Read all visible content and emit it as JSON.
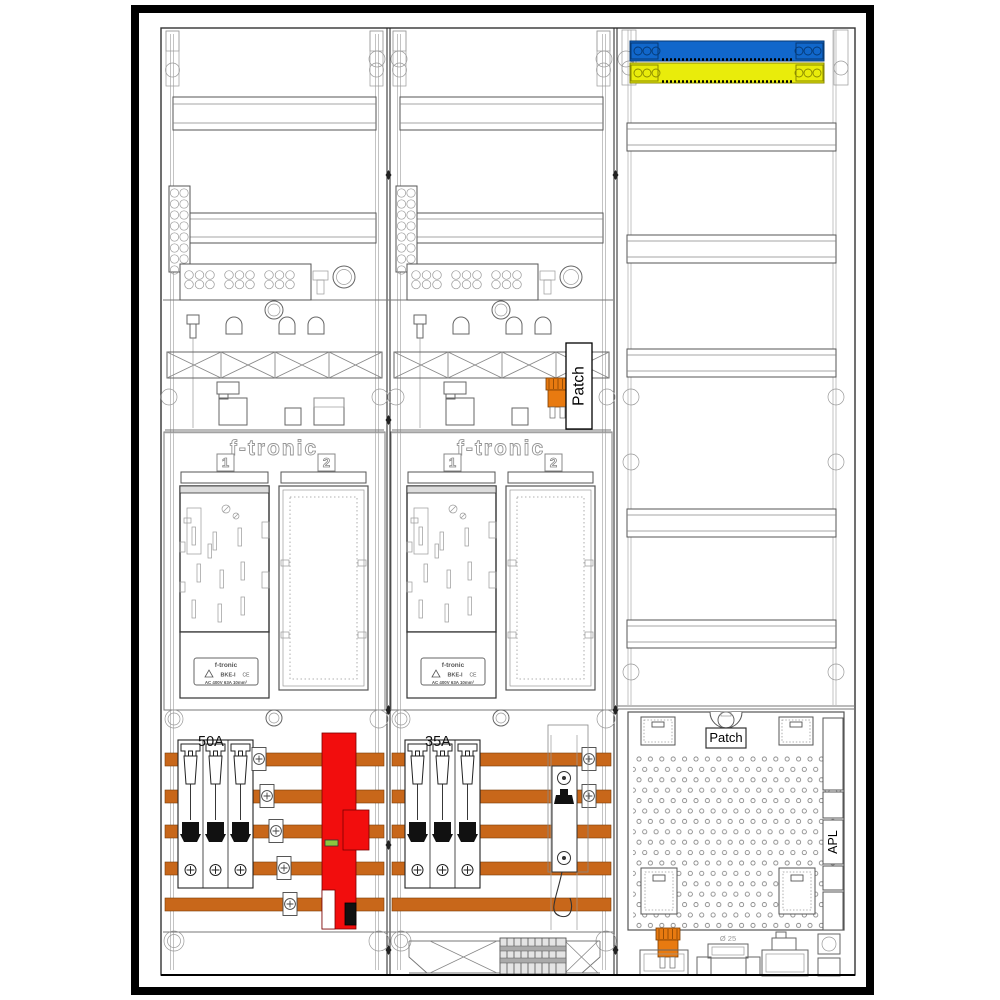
{
  "diagram": {
    "fields": {
      "field1": {
        "brand": "f-tronic",
        "pos1": "1",
        "pos2": "2",
        "fuse_rating": "50A"
      },
      "field2": {
        "brand": "f-tronic",
        "pos1": "1",
        "pos2": "2",
        "fuse_rating": "35A"
      }
    },
    "labels": {
      "patch_mid": "Patch",
      "patch_bottom": "Patch",
      "apl": "APL",
      "grommet_diameter": "Ø 25"
    },
    "bke_plate": {
      "line1": "f-tronic",
      "line2": "BKE-I",
      "ce": "CE",
      "ratings": "AC 400V   63A   10mm²"
    },
    "colors": {
      "busbar": "#c8671a",
      "sls_red": "#f20d0d",
      "neutral_blue": "#1167cb",
      "pe_yellow": "#e9ec0b",
      "connector_orange": "#e87a10",
      "indicator_green": "#8cc63f"
    }
  }
}
